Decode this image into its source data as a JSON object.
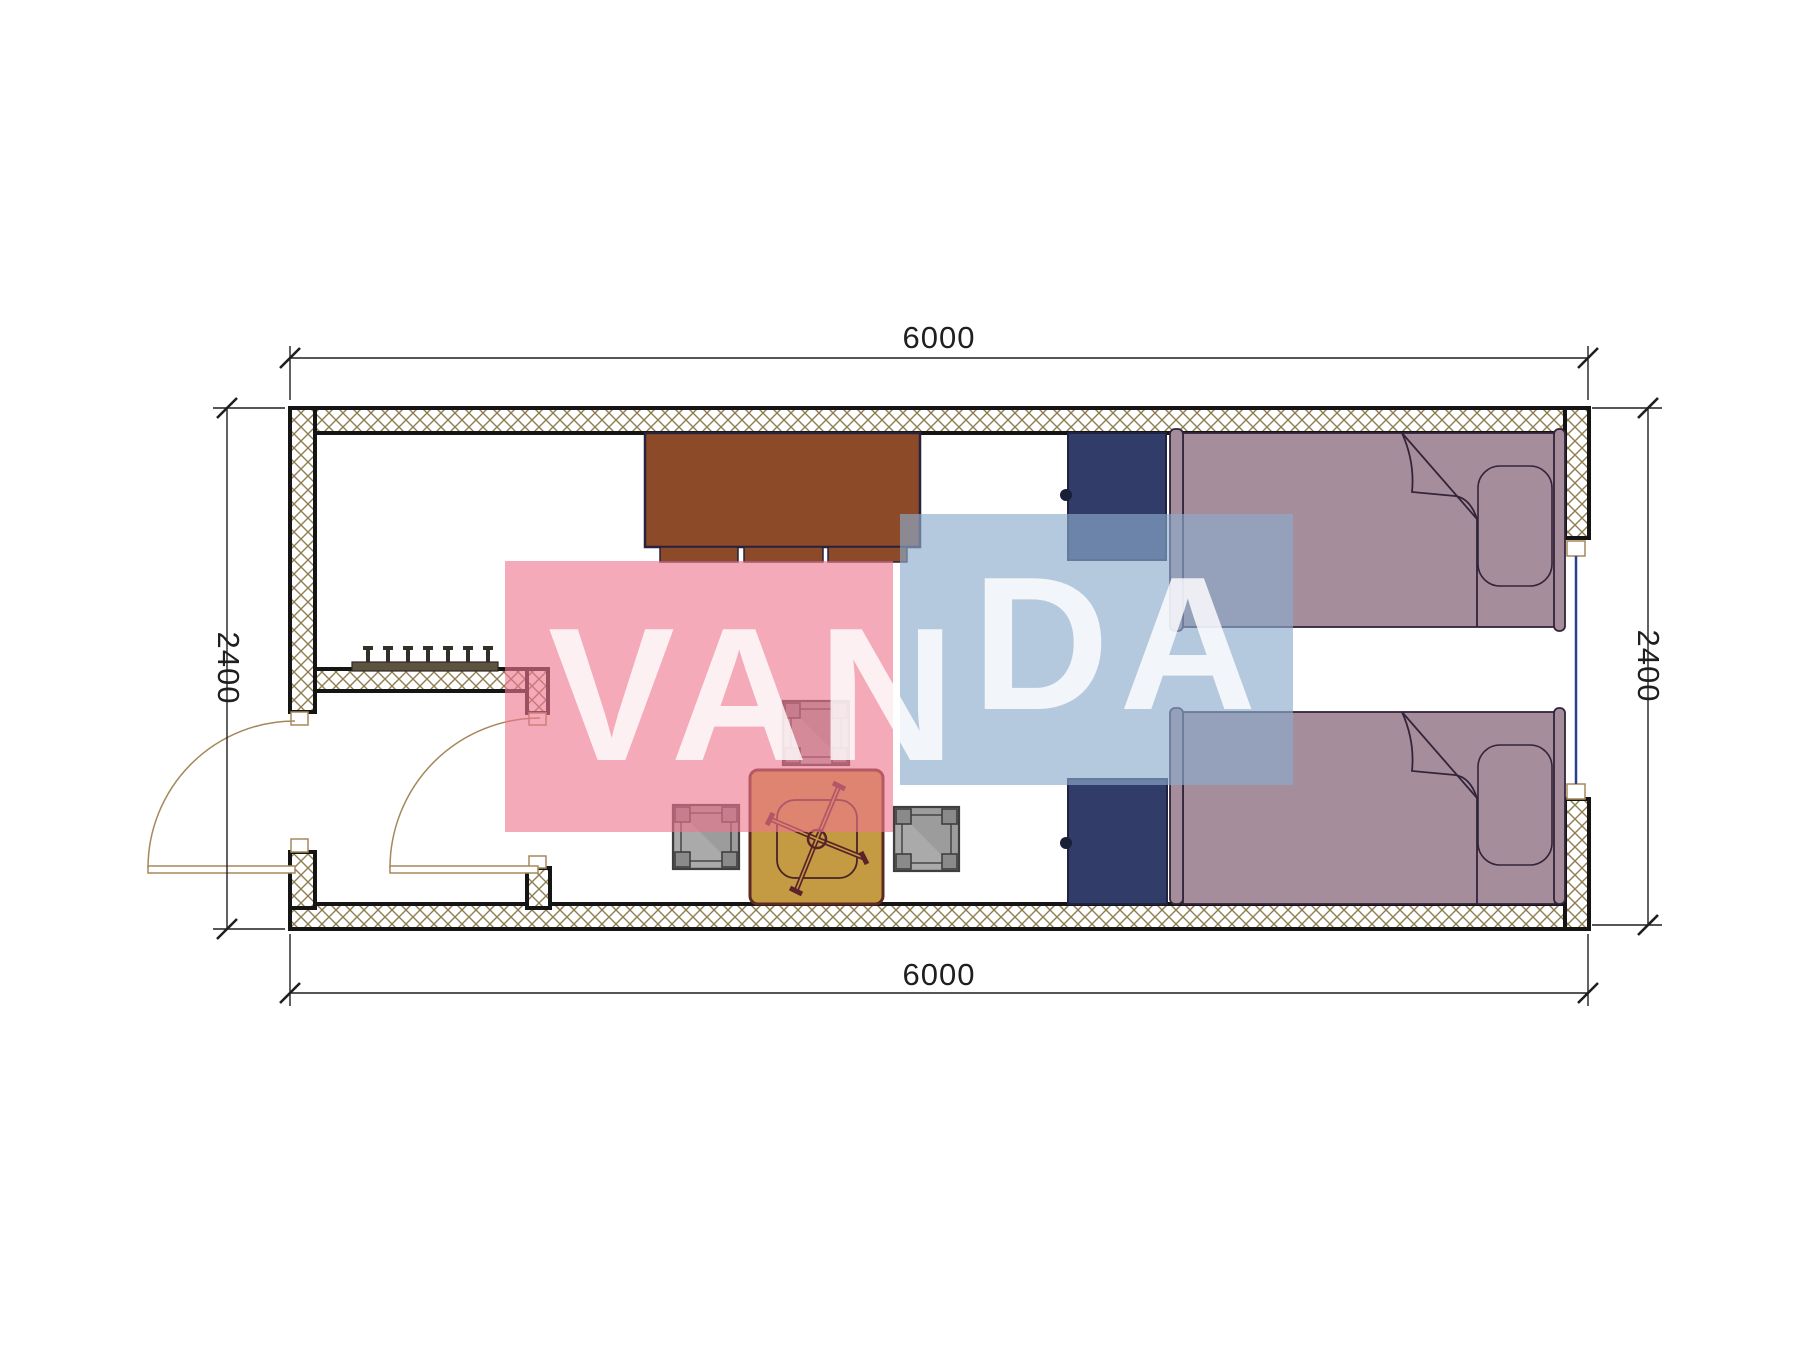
{
  "drawing": {
    "type": "floor-plan",
    "room": "container cabin 6000 x 2400 with entry hall, lounge and twin sleeping area"
  },
  "dimensions": {
    "top": {
      "label": "6000"
    },
    "bottom": {
      "label": "6000"
    },
    "left": {
      "label": "2400"
    },
    "right": {
      "label": "2400"
    }
  },
  "watermark": {
    "text": "VANDA",
    "part1": "VAN",
    "part2": "DA",
    "pink_block": "#f6b6c3",
    "blue_block": "#b8cbe0"
  },
  "colors": {
    "bg": "#ffffff",
    "wall-line": "#151515",
    "hatch": "#8f7d52",
    "door-line": "#a5885a",
    "window-glass": "#2c3f8f",
    "dim-color": "#1f1f1f",
    "cabinet": "#8c4a28",
    "nightstand": "#313c68",
    "bed": "#a68d9b",
    "table": "#c49b42",
    "chair": "#5a232b",
    "stool": "#9c9c9c",
    "rack": "#5d5340",
    "wm-pink": "rgba(238,118,142,0.62)",
    "wm-blue": "rgba(140,170,205,0.65)",
    "wm-text": "rgba(255,255,255,0.82)"
  },
  "furniture": [
    {
      "name": "sideboard-cabinet"
    },
    {
      "name": "nightstand-top"
    },
    {
      "name": "nightstand-bottom"
    },
    {
      "name": "single-bed-top"
    },
    {
      "name": "single-bed-bottom"
    },
    {
      "name": "square-table"
    },
    {
      "name": "chair-cross-base"
    },
    {
      "name": "stool-top"
    },
    {
      "name": "stool-left"
    },
    {
      "name": "stool-right"
    },
    {
      "name": "coat-rack"
    }
  ],
  "openings": [
    {
      "name": "entry-door-exterior",
      "swing": "outward-left"
    },
    {
      "name": "hall-door-interior",
      "swing": "inward"
    },
    {
      "name": "window-right-wall"
    }
  ]
}
